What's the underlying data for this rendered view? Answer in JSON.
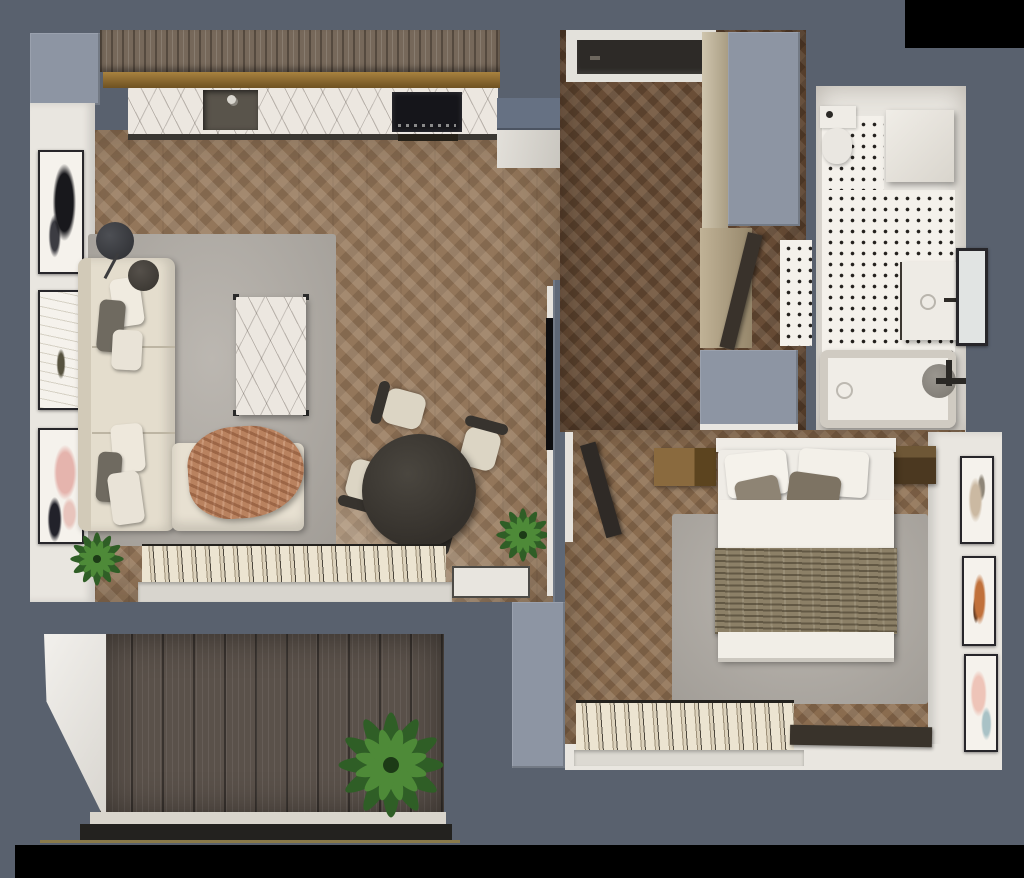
{
  "scene": {
    "title": "Top-down 3D render of a one-bedroom apartment floor plan",
    "view": "top-down dollhouse render, no visible text",
    "rooms": [
      {
        "name": "Living room with open kitchen",
        "position": "top-left",
        "items": [
          "wood kitchen cabinets",
          "brass backsplash strip",
          "white marble countertop",
          "dark undermount sink with faucet",
          "black induction cooktop",
          "tall fridge cabinet",
          "gallery wall with 3 abstract frames",
          "L-shaped cream sofa",
          "white and gray scatter pillows",
          "terracotta throw blanket",
          "black floor lamp",
          "round dark side table",
          "marble coffee table",
          "large gray area rug",
          "round dark dining table",
          "four dining chairs with cream seats",
          "two potted plants",
          "window with open cream blinds",
          "white door mat",
          "media partition wall with wall-mounted TV"
        ]
      },
      {
        "name": "Hallway",
        "position": "top-center",
        "items": [
          "dark entrance door with white frame",
          "beige built-in wardrobe",
          "slate storage closet tops",
          "open bathroom door showing tile"
        ]
      },
      {
        "name": "Bathroom",
        "position": "top-right",
        "items": [
          "toilet with flush button",
          "washing machine",
          "white mosaic floor with black dots",
          "white vanity basin with faucet",
          "dark framed wall mirror",
          "white bathtub",
          "black bath fittings",
          "round gray stool"
        ]
      },
      {
        "name": "Bedroom",
        "position": "bottom-right",
        "items": [
          "double bed with white duvet",
          "olive wrinkled throw",
          "two white and two taupe pillows",
          "light wood nightstand",
          "dark wood nightstand",
          "gray area rug",
          "gallery wall with 3 pastel frames",
          "window with open blinds",
          "dark runner mat",
          "open dark door"
        ]
      },
      {
        "name": "Balcony",
        "position": "bottom-left",
        "items": [
          "vertical dark wood decking",
          "white side wall",
          "light railing sill",
          "large green potted plant"
        ]
      }
    ],
    "palette": {
      "outer_wall_slate": "#59616e",
      "light_slate_block": "#8d95a3",
      "interior_white_wall": "#e9e6e0",
      "living_floor_oak": "#93765a",
      "hallway_floor_oak": "#6a4e37",
      "bedroom_floor_oak": "#8a6c4f",
      "balcony_decking": "#5a514a",
      "kitchen_cabinet_wood": "#76685a",
      "brass_backsplash": "#96742f",
      "marble_white": "#ece7e0",
      "rug_gray": "#b4afa8",
      "sofa_cream": "#e4ddcd",
      "throw_terracotta": "#b9825f",
      "bed_throw_olive": "#8c8067",
      "tile_white": "#f4f1eb",
      "plant_green": "#356328",
      "door_dark": "#2d2a27",
      "void_black": "#000000"
    }
  }
}
